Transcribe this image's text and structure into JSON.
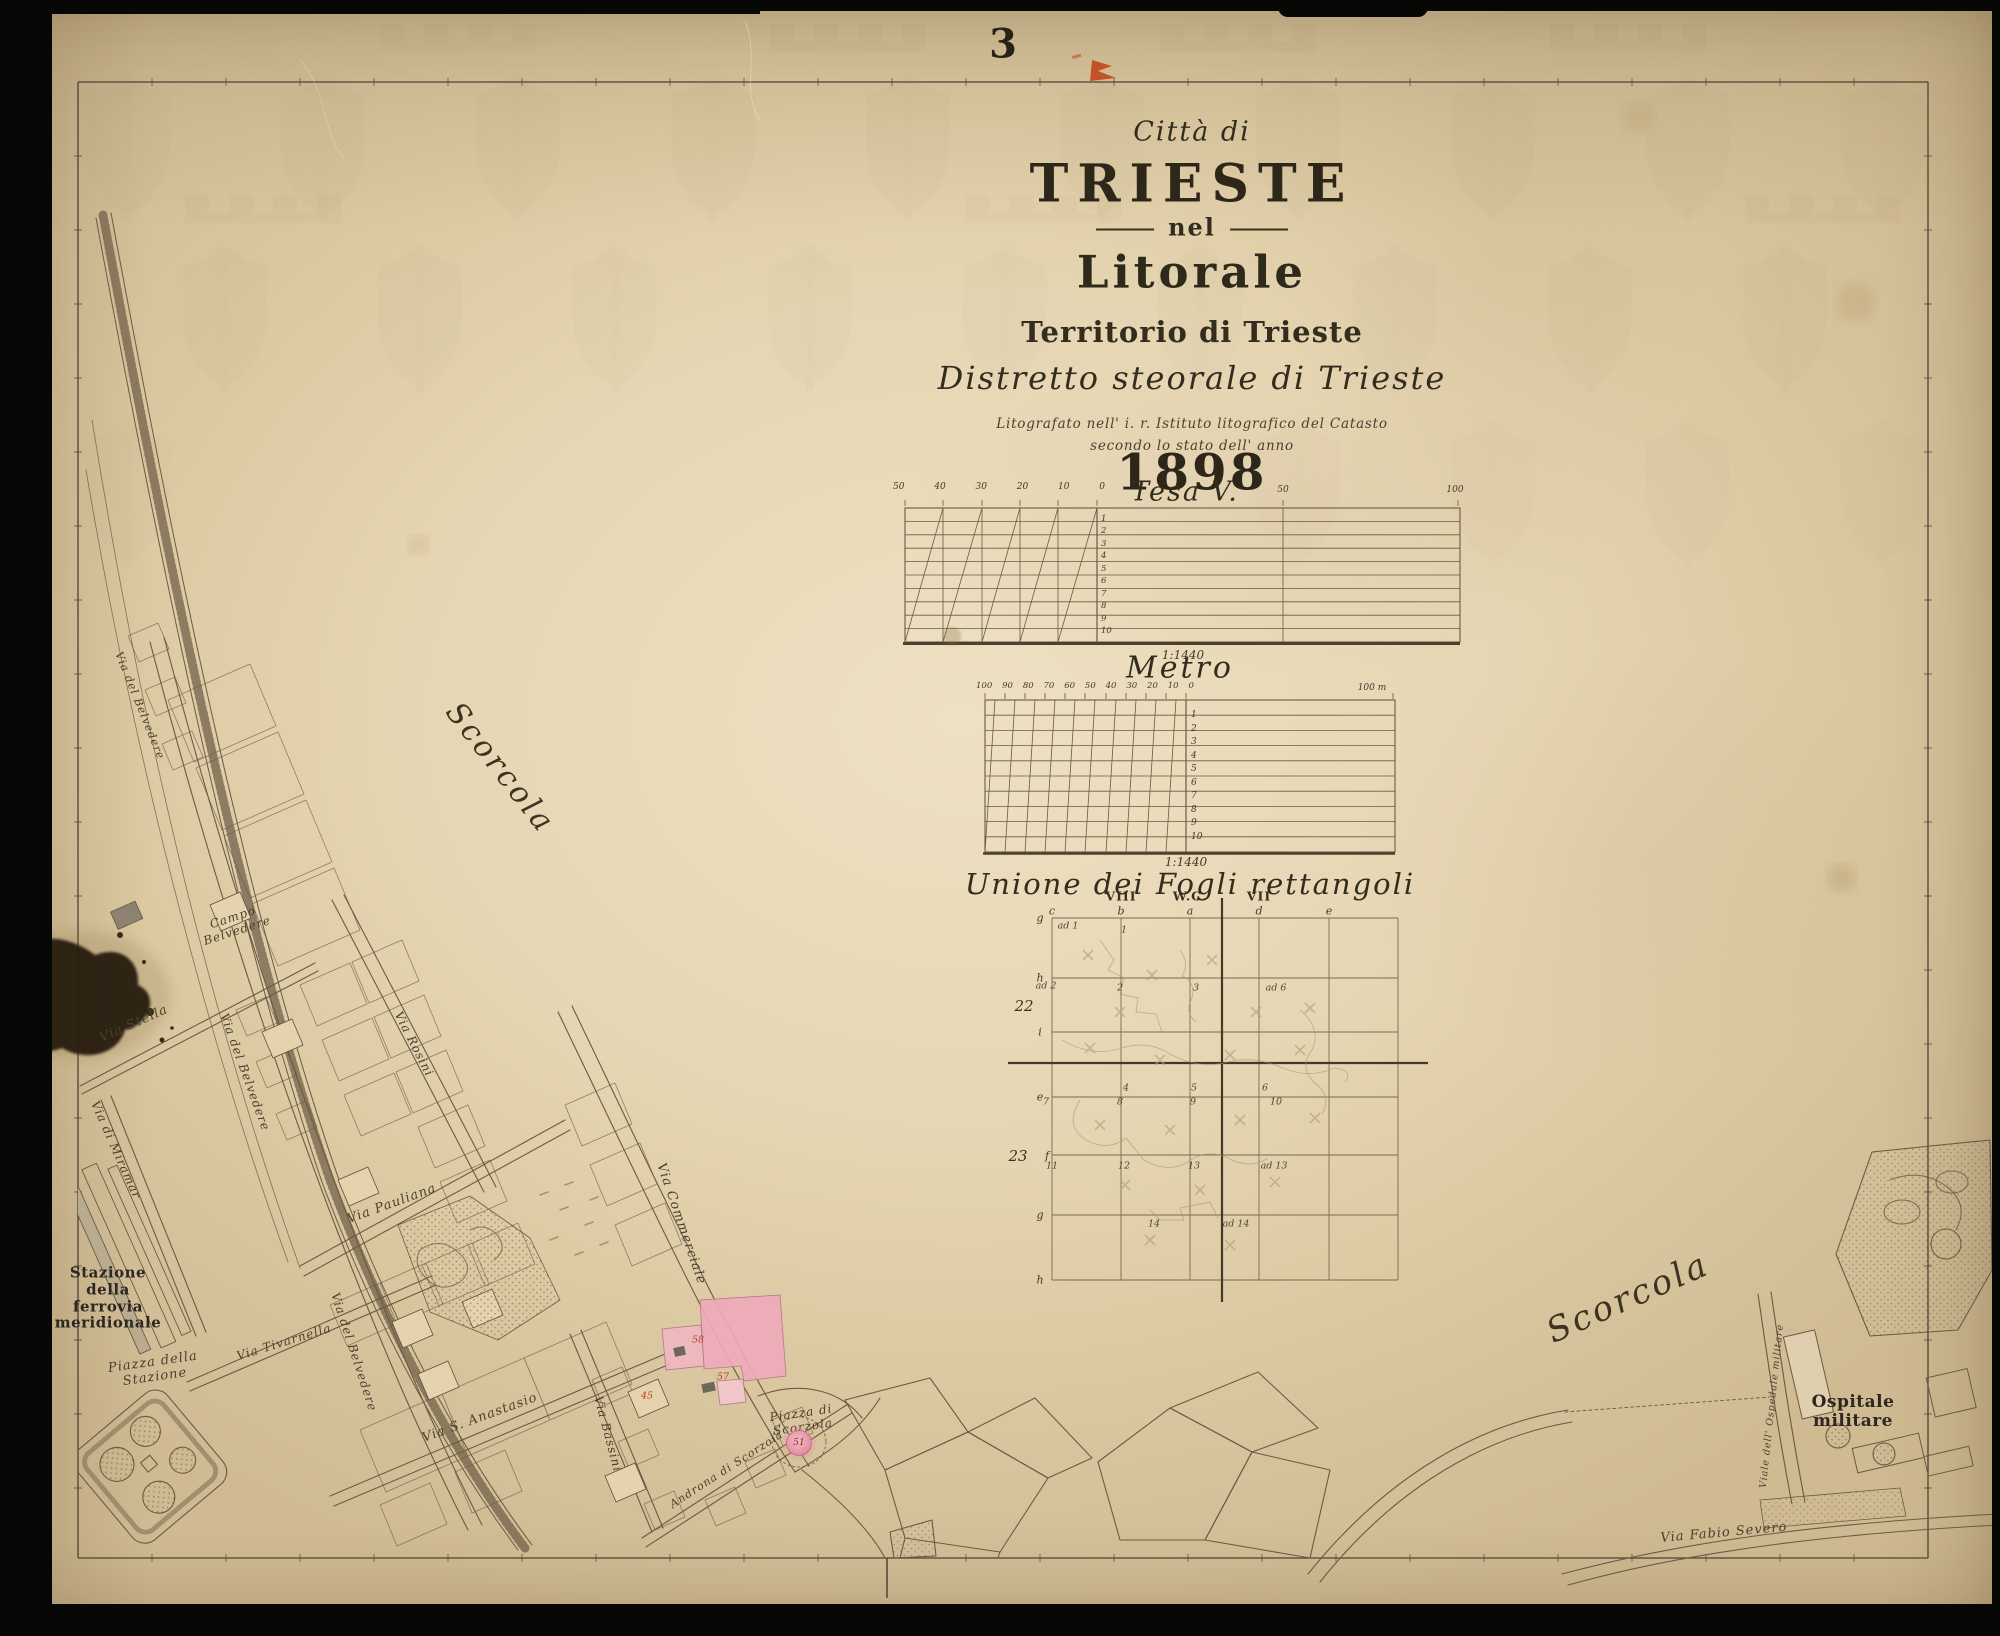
{
  "sheet": {
    "number": "3"
  },
  "title_block": {
    "city_line": "Città di",
    "city_name": "TRIESTE",
    "nel": "nel",
    "litorale": "Litorale",
    "territorio": "Territorio di Trieste",
    "distretto": "Distretto steorale di Trieste",
    "imprint1": "Litografato nell' i. r. Istituto litografico del Catasto",
    "imprint2": "secondo lo stato dell' anno",
    "year": "1898"
  },
  "scales": {
    "tesa": {
      "title": "Tesa V.",
      "ratio": "1:1440",
      "top_labels": [
        "50",
        "40",
        "30",
        "20",
        "10",
        "0"
      ],
      "right_labels": [
        "50",
        "100"
      ],
      "row_labels": [
        "1",
        "2",
        "3",
        "4",
        "5",
        "6",
        "7",
        "8",
        "9",
        "10"
      ]
    },
    "metro": {
      "title": "Metro",
      "ratio": "1:1440",
      "top_labels": [
        "100",
        "90",
        "80",
        "70",
        "60",
        "50",
        "40",
        "30",
        "20",
        "10",
        "0"
      ],
      "end_label": "100 m",
      "row_labels": [
        "1",
        "2",
        "3",
        "4",
        "5",
        "6",
        "7",
        "8",
        "9",
        "10"
      ]
    }
  },
  "index_diagram": {
    "title": "Unione dei Fogli rettangoli",
    "roman_headers": [
      {
        "t": "VIII",
        "x": 1121,
        "y": 896,
        "nm": "index-col-viii"
      },
      {
        "t": "W.C.",
        "x": 1190,
        "y": 896,
        "nm": "index-col-wc"
      },
      {
        "t": "VII",
        "x": 1259,
        "y": 896,
        "nm": "index-col-vii"
      }
    ],
    "column_letters": [
      {
        "t": "c",
        "x": 1052,
        "y": 911,
        "nm": "index-letter-c"
      },
      {
        "t": "b",
        "x": 1121,
        "y": 911,
        "nm": "index-letter-b"
      },
      {
        "t": "a",
        "x": 1190,
        "y": 911,
        "nm": "index-letter-a"
      },
      {
        "t": "d",
        "x": 1259,
        "y": 911,
        "nm": "index-letter-d"
      },
      {
        "t": "e",
        "x": 1329,
        "y": 911,
        "nm": "index-letter-e"
      }
    ],
    "row_letters": [
      {
        "t": "g",
        "x": 1040,
        "y": 918,
        "nm": "index-row-g1"
      },
      {
        "t": "h",
        "x": 1040,
        "y": 978,
        "nm": "index-row-h1"
      },
      {
        "t": "i",
        "x": 1040,
        "y": 1032,
        "nm": "index-row-i"
      },
      {
        "t": "e",
        "x": 1040,
        "y": 1097,
        "nm": "index-row-e"
      },
      {
        "t": "f",
        "x": 1047,
        "y": 1156,
        "nm": "index-row-f"
      },
      {
        "t": "g",
        "x": 1040,
        "y": 1215,
        "nm": "index-row-g2"
      },
      {
        "t": "h",
        "x": 1040,
        "y": 1280,
        "nm": "index-row-h2"
      }
    ],
    "row_numbers": [
      {
        "t": "22",
        "x": 1024,
        "y": 1006,
        "nm": "index-rownum-22"
      },
      {
        "t": "23",
        "x": 1018,
        "y": 1156,
        "nm": "index-rownum-23"
      }
    ],
    "cells": [
      {
        "t": "ad 1",
        "x": 1068,
        "y": 926
      },
      {
        "t": "1",
        "x": 1124,
        "y": 930
      },
      {
        "t": "ad 2",
        "x": 1046,
        "y": 986
      },
      {
        "t": "2",
        "x": 1120,
        "y": 988
      },
      {
        "t": "3",
        "x": 1196,
        "y": 988
      },
      {
        "t": "ad 6",
        "x": 1276,
        "y": 988
      },
      {
        "t": "4",
        "x": 1126,
        "y": 1088
      },
      {
        "t": "5",
        "x": 1194,
        "y": 1088
      },
      {
        "t": "6",
        "x": 1265,
        "y": 1088
      },
      {
        "t": "7",
        "x": 1046,
        "y": 1102
      },
      {
        "t": "8",
        "x": 1120,
        "y": 1102
      },
      {
        "t": "9",
        "x": 1193,
        "y": 1102
      },
      {
        "t": "10",
        "x": 1276,
        "y": 1102
      },
      {
        "t": "11",
        "x": 1052,
        "y": 1166
      },
      {
        "t": "12",
        "x": 1124,
        "y": 1166
      },
      {
        "t": "13",
        "x": 1194,
        "y": 1166
      },
      {
        "t": "ad 13",
        "x": 1274,
        "y": 1166
      },
      {
        "t": "14",
        "x": 1154,
        "y": 1224
      },
      {
        "t": "ad 14",
        "x": 1236,
        "y": 1224
      }
    ]
  },
  "map": {
    "labels": [
      {
        "t": "Scorcola",
        "x": 500,
        "y": 768,
        "r": 52,
        "fs": 30,
        "cls": "script",
        "nm": "scorcola-label-left"
      },
      {
        "t": "Via del Belvedere",
        "x": 139,
        "y": 706,
        "r": 68,
        "fs": 11,
        "nm": "via-del-belvedere-label-upper"
      },
      {
        "t": "Campo\nBelvedere",
        "x": 235,
        "y": 924,
        "r": -18,
        "fs": 12,
        "nm": "campo-belvedere-label"
      },
      {
        "t": "Via Stella",
        "x": 134,
        "y": 1024,
        "r": -24,
        "fs": 13,
        "nm": "via-stella-label"
      },
      {
        "t": "Via del Belvedere",
        "x": 245,
        "y": 1072,
        "r": 70,
        "fs": 12,
        "nm": "via-del-belvedere-label-mid"
      },
      {
        "t": "Via di Miramar",
        "x": 116,
        "y": 1150,
        "r": 66,
        "fs": 12,
        "nm": "via-di-miramar-label"
      },
      {
        "t": "Via Rosini",
        "x": 414,
        "y": 1044,
        "r": 63,
        "fs": 12,
        "nm": "via-rosini-label"
      },
      {
        "t": "Via Pauliana",
        "x": 392,
        "y": 1204,
        "r": -20,
        "fs": 13,
        "nm": "via-pauliana-label"
      },
      {
        "t": "Via del Belvedere",
        "x": 354,
        "y": 1352,
        "r": 72,
        "fs": 12,
        "nm": "via-del-belvedere-label-lower"
      },
      {
        "t": "Via Commerciale",
        "x": 681,
        "y": 1224,
        "r": 71,
        "fs": 13,
        "nm": "via-commerciale-label"
      },
      {
        "t": "Stazione\ndella\nferrovia\nmeridionale",
        "x": 108,
        "y": 1298,
        "r": 0,
        "fs": 15,
        "cls": "bold",
        "nm": "stazione-ferrovia-meridionale-label"
      },
      {
        "t": "Piazza della\nStazione",
        "x": 154,
        "y": 1370,
        "r": -8,
        "fs": 13,
        "nm": "piazza-della-stazione-label"
      },
      {
        "t": "Via Tivarnella",
        "x": 284,
        "y": 1342,
        "r": -17,
        "fs": 12,
        "nm": "via-tivarnella-label"
      },
      {
        "t": "Via S. Anastasio",
        "x": 480,
        "y": 1418,
        "r": -20,
        "fs": 13,
        "nm": "via-s-anastasio-label"
      },
      {
        "t": "Via Bassini",
        "x": 608,
        "y": 1434,
        "r": 75,
        "fs": 12,
        "nm": "via-bassini-label"
      },
      {
        "t": "Piazza di\nScorzola",
        "x": 802,
        "y": 1420,
        "r": -8,
        "fs": 12,
        "nm": "piazza-di-scorzola-label"
      },
      {
        "t": "Androna di Scorzola",
        "x": 727,
        "y": 1470,
        "r": -33,
        "fs": 11,
        "nm": "androna-di-scorzola-label"
      },
      {
        "t": "Scorcola",
        "x": 1628,
        "y": 1298,
        "r": -24,
        "fs": 34,
        "cls": "script",
        "nm": "scorcola-label-right"
      },
      {
        "t": "Ospitale militare",
        "x": 1853,
        "y": 1412,
        "r": 0,
        "fs": 17,
        "cls": "bold",
        "nm": "ospitale-militare-label"
      },
      {
        "t": "Viale dell' Ospedale militare",
        "x": 1772,
        "y": 1406,
        "r": -84,
        "fs": 9.5,
        "nm": "viale-ospedale-militare-label"
      },
      {
        "t": "Via Fabio Severo",
        "x": 1724,
        "y": 1533,
        "r": -5,
        "fs": 13,
        "nm": "via-fabio-severo-label"
      }
    ],
    "red_numbers": [
      {
        "t": "58",
        "x": 698,
        "y": 1340,
        "nm": "parcel-number-58"
      },
      {
        "t": "57",
        "x": 723,
        "y": 1377,
        "nm": "parcel-number-57"
      },
      {
        "t": "45",
        "x": 647,
        "y": 1396,
        "nm": "parcel-number-45"
      }
    ],
    "piazza_marker": "51"
  },
  "colors": {
    "paper": "#e6d5b2",
    "ink": "#6b5a45",
    "pink_building": "#edaabb",
    "red_accent": "#bd3a1e",
    "orange_stamp": "#c4491c"
  }
}
